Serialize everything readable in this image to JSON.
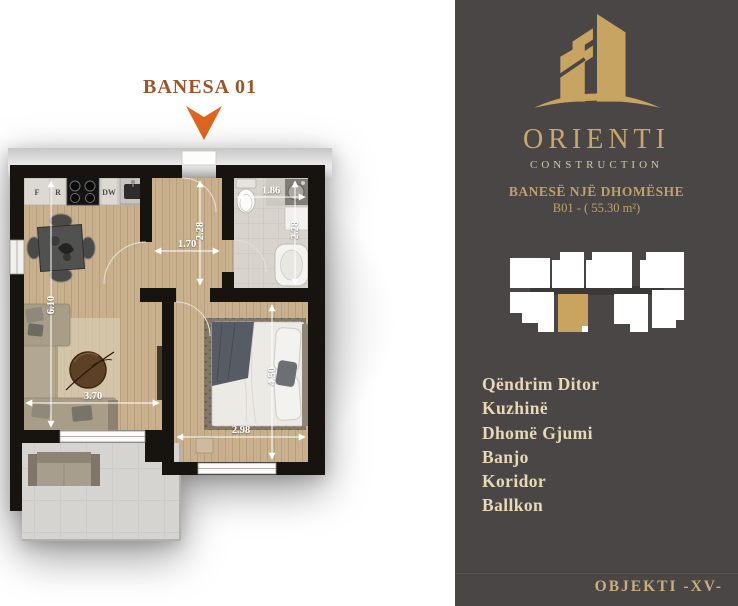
{
  "title": {
    "label": "BANESA 01"
  },
  "floorplan": {
    "dimensions": {
      "kitchen_living_height": "6.10",
      "living_width": "3.70",
      "corridor_width": "1.70",
      "corridor_height": "2.28",
      "bathroom_width": "1.86",
      "bathroom_height": "2.28",
      "bedroom_height": "4.50",
      "bedroom_width": "2.98"
    },
    "kitchen_labels": {
      "fridge": "F",
      "right_unit": "R",
      "dishwasher": "DW"
    }
  },
  "sidebar": {
    "logo": {
      "brand": "ORIENTI",
      "subtitle": "CONSTRUCTION"
    },
    "apartment": {
      "type": "BANESË NJË DHOMËSHE",
      "unit": "B01 - ( 55.30 m²)"
    },
    "rooms": [
      "Qëndrim Ditor",
      "Kuzhinë",
      "Dhomë Gjumi",
      "Banjo",
      "Koridor",
      "Ballkon"
    ],
    "footer": "OBJEKTI -XV-"
  },
  "colors": {
    "sidebar_bg": "#494645",
    "gold": "#c8a462",
    "accent_orange": "#e0661e",
    "title_brown": "#9d5429",
    "wall_black": "#17130f"
  }
}
